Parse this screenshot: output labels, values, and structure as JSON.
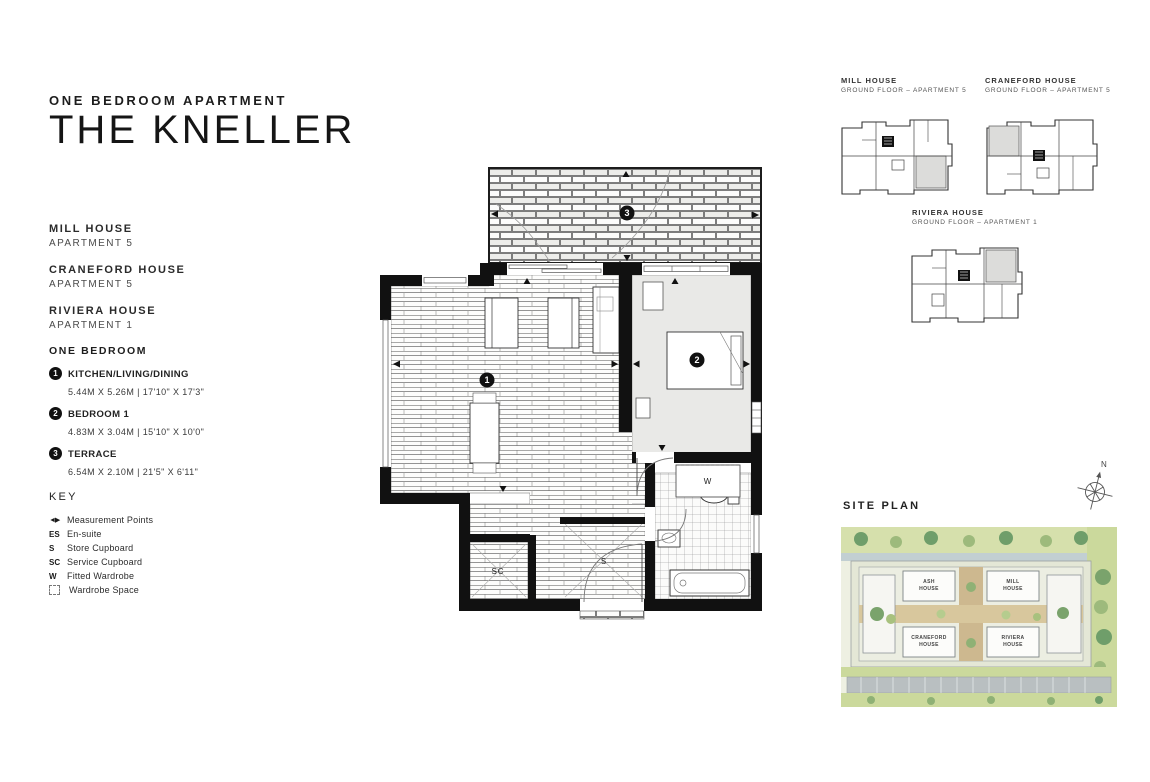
{
  "header": {
    "subtitle": "ONE BEDROOM APARTMENT",
    "title": "THE KNELLER"
  },
  "buildings": [
    {
      "name": "MILL HOUSE",
      "apartment": "APARTMENT 5"
    },
    {
      "name": "CRANEFORD HOUSE",
      "apartment": "APARTMENT 5"
    },
    {
      "name": "RIVIERA HOUSE",
      "apartment": "APARTMENT 1"
    }
  ],
  "rooms": {
    "heading": "ONE BEDROOM",
    "items": [
      {
        "num": "1",
        "name": "KITCHEN/LIVING/DINING",
        "dims": "5.44M X 5.26M | 17'10\" X 17'3\""
      },
      {
        "num": "2",
        "name": "BEDROOM 1",
        "dims": "4.83M X 3.04M | 15'10\" X 10'0\""
      },
      {
        "num": "3",
        "name": "TERRACE",
        "dims": "6.54M X 2.10M | 21'5\" X 6'11\""
      }
    ]
  },
  "key": {
    "heading": "KEY",
    "items": [
      {
        "symbol": "◄▶",
        "label": "Measurement Points"
      },
      {
        "symbol": "ES",
        "label": "En-suite"
      },
      {
        "symbol": "S",
        "label": "Store Cupboard"
      },
      {
        "symbol": "SC",
        "label": "Service Cupboard"
      },
      {
        "symbol": "W",
        "label": "Fitted Wardrobe"
      },
      {
        "symbol": "",
        "label": "Wardrobe Space"
      }
    ]
  },
  "floorplan": {
    "marker_kitchen": "1",
    "marker_bedroom": "2",
    "marker_terrace": "3",
    "wardrobe_label": "W",
    "service_cupboard_label": "SC",
    "store_cupboard_label": "S"
  },
  "thumbnails": [
    {
      "name": "MILL HOUSE",
      "floor": "GROUND FLOOR – APARTMENT 5"
    },
    {
      "name": "CRANEFORD HOUSE",
      "floor": "GROUND FLOOR – APARTMENT 5"
    },
    {
      "name": "RIVIERA HOUSE",
      "floor": "GROUND FLOOR – APARTMENT 1"
    }
  ],
  "siteplan": {
    "heading": "SITE PLAN",
    "compass_north": "N",
    "buildings": [
      {
        "label": "ASH\nHOUSE"
      },
      {
        "label": "MILL\nHOUSE"
      },
      {
        "label": "CRANEFORD\nHOUSE"
      },
      {
        "label": "RIVIERA\nHOUSE"
      }
    ]
  },
  "colors": {
    "wall": "#111111",
    "bedroom_floor": "#e9e9e7",
    "site_green_light": "#dbe5b4",
    "site_green_mid": "#b9cc8e",
    "site_tree_dark": "#6f9e6a",
    "site_road": "#b9bfc1",
    "site_path_tan": "#cdb88f"
  }
}
